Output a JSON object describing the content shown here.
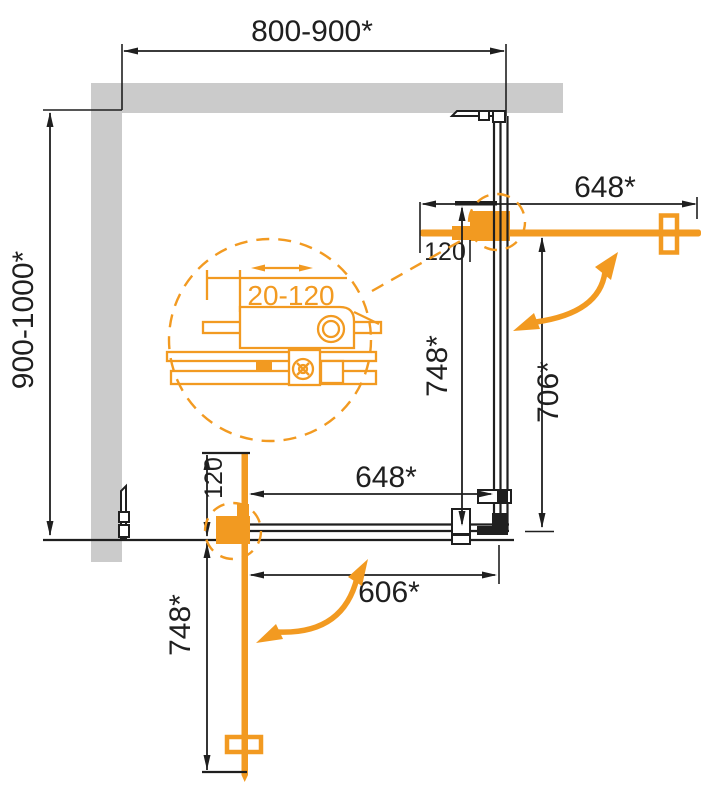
{
  "drawing": {
    "type": "technical-plan",
    "subject": "corner shower enclosure, top view with pivot doors and wall profiles",
    "colors": {
      "accent_orange": "#F29A21",
      "wall_gray": "#CBCBCB",
      "line_black": "#1F1F1F",
      "background": "#FFFFFF"
    },
    "labels": {
      "overall_width": "800-900*",
      "overall_depth": "900-1000*",
      "right_door_width": "648*",
      "right_hinge_offset": "120",
      "right_glass_a": "748*",
      "right_glass_b": "706*",
      "bottom_panel_width": "648*",
      "bottom_hinge_offset": "120",
      "bottom_opening_width": "606*",
      "bottom_glass_a": "748*",
      "profile_adjustment_range": "20-120"
    }
  }
}
